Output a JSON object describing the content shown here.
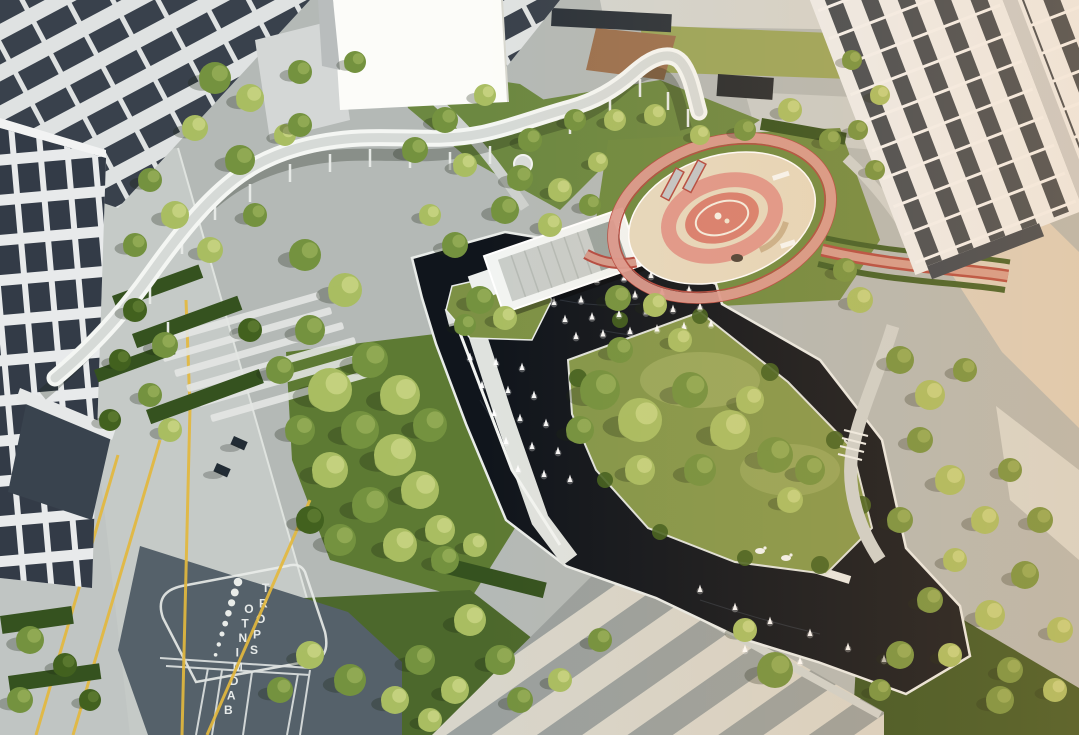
{
  "meta": {
    "title": "Aerial drone photograph of a residential landscape courtyard at golden hour",
    "scene_type": "aerial-photograph"
  },
  "ground_markings": {
    "badminton_label_vertical": "BADMINTO",
    "sport_label_vertical": "SPORT"
  },
  "scene": {
    "features": [
      "white apartment buildings and towers",
      "serpentine elevated white walkway on columns",
      "dark reflecting pool with white fountain jets",
      "flat-roofed water pavilion",
      "pink circular children's playground with running track",
      "lawn peninsula with tree groves",
      "diagonally striped paved plaza",
      "badminton sport court with painted markings",
      "yellow pavement guide lines",
      "zebra-striped pedestrian paving"
    ]
  },
  "palette": {
    "paving": "#b4b9b6",
    "road": "#c5cac7",
    "water": "#10151c",
    "lawn": "#84974a",
    "tree_light": "#a9bd62",
    "tree_mid": "#74923f",
    "tree_dark": "#42611f",
    "playground_pink": "#e09a92",
    "playground_red": "#d87f70",
    "playground_sand": "#e6d9bf",
    "track_red": "#b44b42",
    "bridge_white": "#f4f6f3",
    "building_white": "#e9ebec",
    "window_dark": "#313a45",
    "court_dark": "#55616a",
    "line_yellow": "#e3b83e",
    "stripe_light": "#d8d5ca",
    "stripe_gray": "#9aa09e"
  }
}
